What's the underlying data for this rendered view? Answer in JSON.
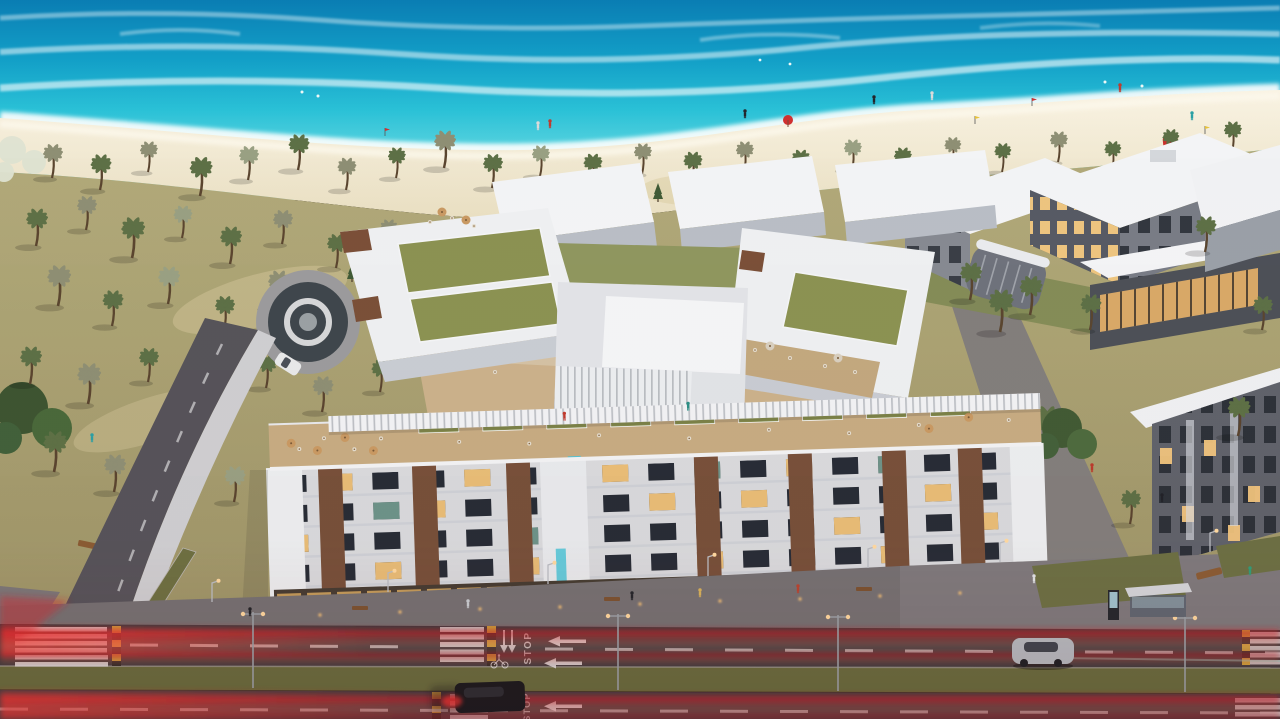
{
  "image": {
    "kind": "aerial architectural rendering at dusk",
    "subject": "beachfront residential complex with rooftop terraces, palm grove, turquoise sea and coastal highway with light trails"
  },
  "road": {
    "stop_text": "STOP"
  },
  "palette": {
    "ocean_deep": "#0a7db3",
    "ocean_turquoise": "#2ac1d7",
    "surf_foam": "#eafbfa",
    "beach_sand": "#f3ead5",
    "grove_ground": "#ada573",
    "building_white": "#f2f3f5",
    "building_shade": "#c6cad2",
    "brick_accent": "#77503a",
    "green_roof": "#8b9252",
    "window_lit": "#f4c87c",
    "window_dark": "#272c36",
    "asphalt": "#3d3a3e",
    "light_trail_red": "#d6232b",
    "median_grass": "#686c3e",
    "deck_wood": "#c7ac83",
    "pool_cyan": "#4fc3d6"
  }
}
